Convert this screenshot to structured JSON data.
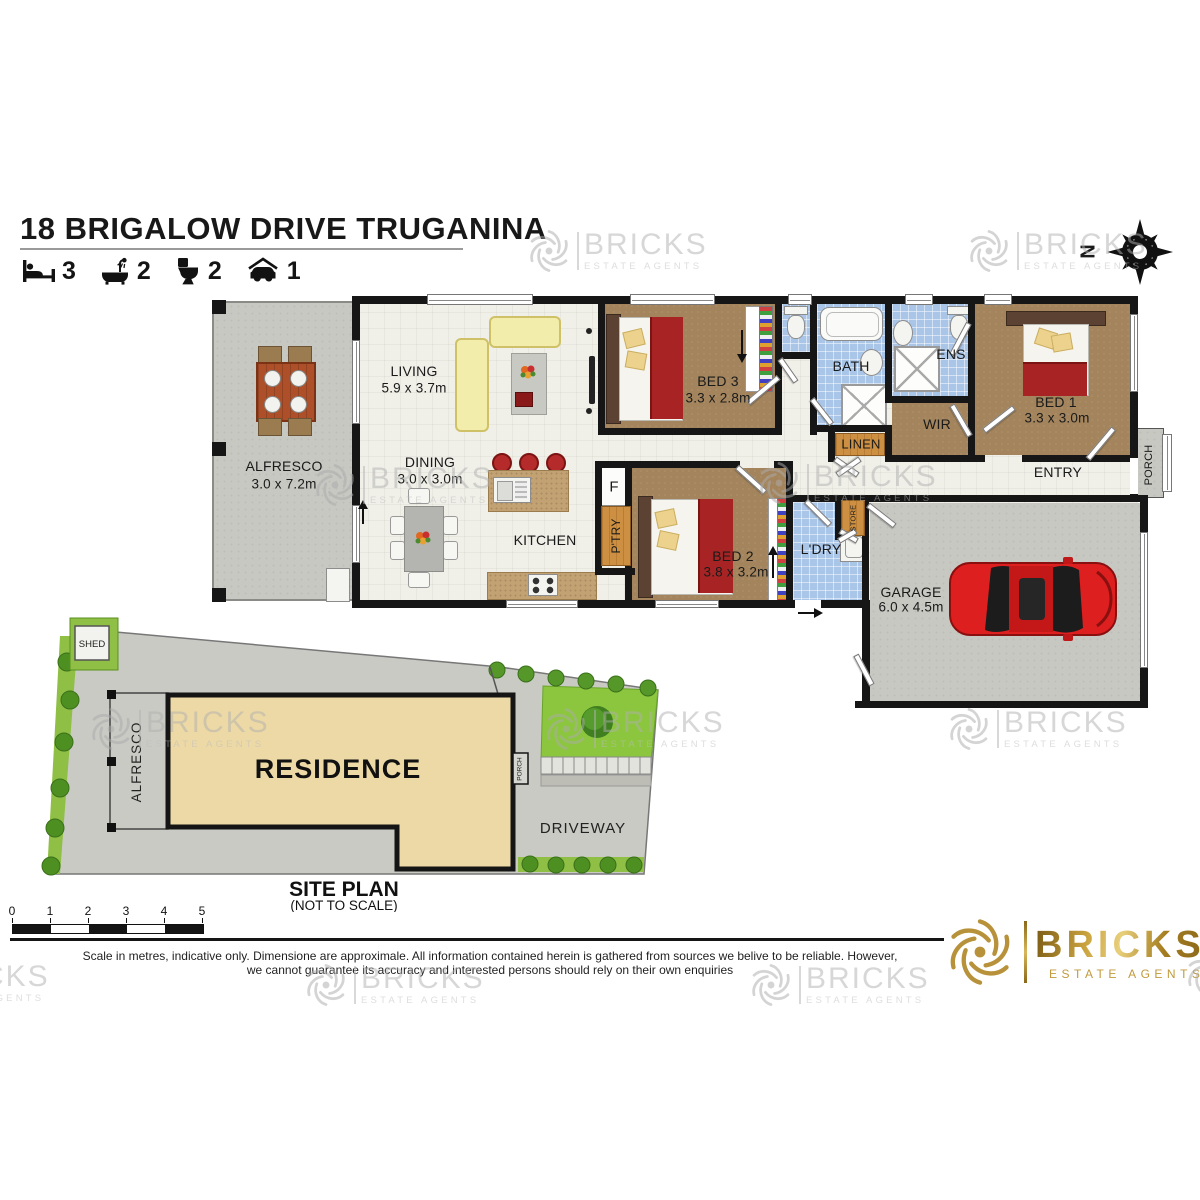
{
  "header": {
    "title": "18 BRIGALOW DRIVE TRUGANINA",
    "features": [
      {
        "icon": "bed-icon",
        "count": "3"
      },
      {
        "icon": "bath-icon",
        "count": "2"
      },
      {
        "icon": "toilet-icon",
        "count": "2"
      },
      {
        "icon": "car-icon",
        "count": "1"
      }
    ]
  },
  "compass": {
    "north_label": "N"
  },
  "floorplan": {
    "rooms": {
      "alfresco": {
        "name": "ALFRESCO",
        "dims": "3.0 x 7.2m"
      },
      "living": {
        "name": "LIVING",
        "dims": "5.9 x 3.7m"
      },
      "dining": {
        "name": "DINING",
        "dims": "3.0 x 3.0m"
      },
      "kitchen": {
        "name": "KITCHEN"
      },
      "ptry": {
        "name": "P'TRY"
      },
      "fridge": {
        "name": "F"
      },
      "bed1": {
        "name": "BED 1",
        "dims": "3.3 x 3.0m"
      },
      "bed2": {
        "name": "BED 2",
        "dims": "3.8 x 3.2m"
      },
      "bed3": {
        "name": "BED 3",
        "dims": "3.3 x 2.8m"
      },
      "bath": {
        "name": "BATH"
      },
      "ens": {
        "name": "ENS"
      },
      "wir": {
        "name": "WIR"
      },
      "linen": {
        "name": "LINEN"
      },
      "store": {
        "name": "STORE"
      },
      "ldry": {
        "name": "L'DRY"
      },
      "entry": {
        "name": "ENTRY"
      },
      "porch": {
        "name": "PORCH"
      },
      "garage": {
        "name": "GARAGE",
        "dims": "6.0 x 4.5m"
      }
    }
  },
  "siteplan": {
    "shed": "SHED",
    "alfresco": "ALFRESCO",
    "residence": "RESIDENCE",
    "porch": "PORCH",
    "driveway": "DRIVEWAY",
    "title": "SITE PLAN",
    "subtitle": "(NOT TO SCALE)"
  },
  "scalebar": {
    "ticks": [
      "0",
      "1",
      "2",
      "3",
      "4",
      "5"
    ]
  },
  "footer": {
    "disclaimer_line1": "Scale in metres, indicative only. Dimensione are approximale. All information contained herein is gathered from sources we belive to be reliable. However,",
    "disclaimer_line2": "we cannot guarantee its accuracy and interested persons should rely on their own enquiries"
  },
  "brand": {
    "name": "BRICKS",
    "tagline": "ESTATE AGENTS",
    "gold": "#b8923a",
    "watermark_gray": "#c6c6c6"
  }
}
